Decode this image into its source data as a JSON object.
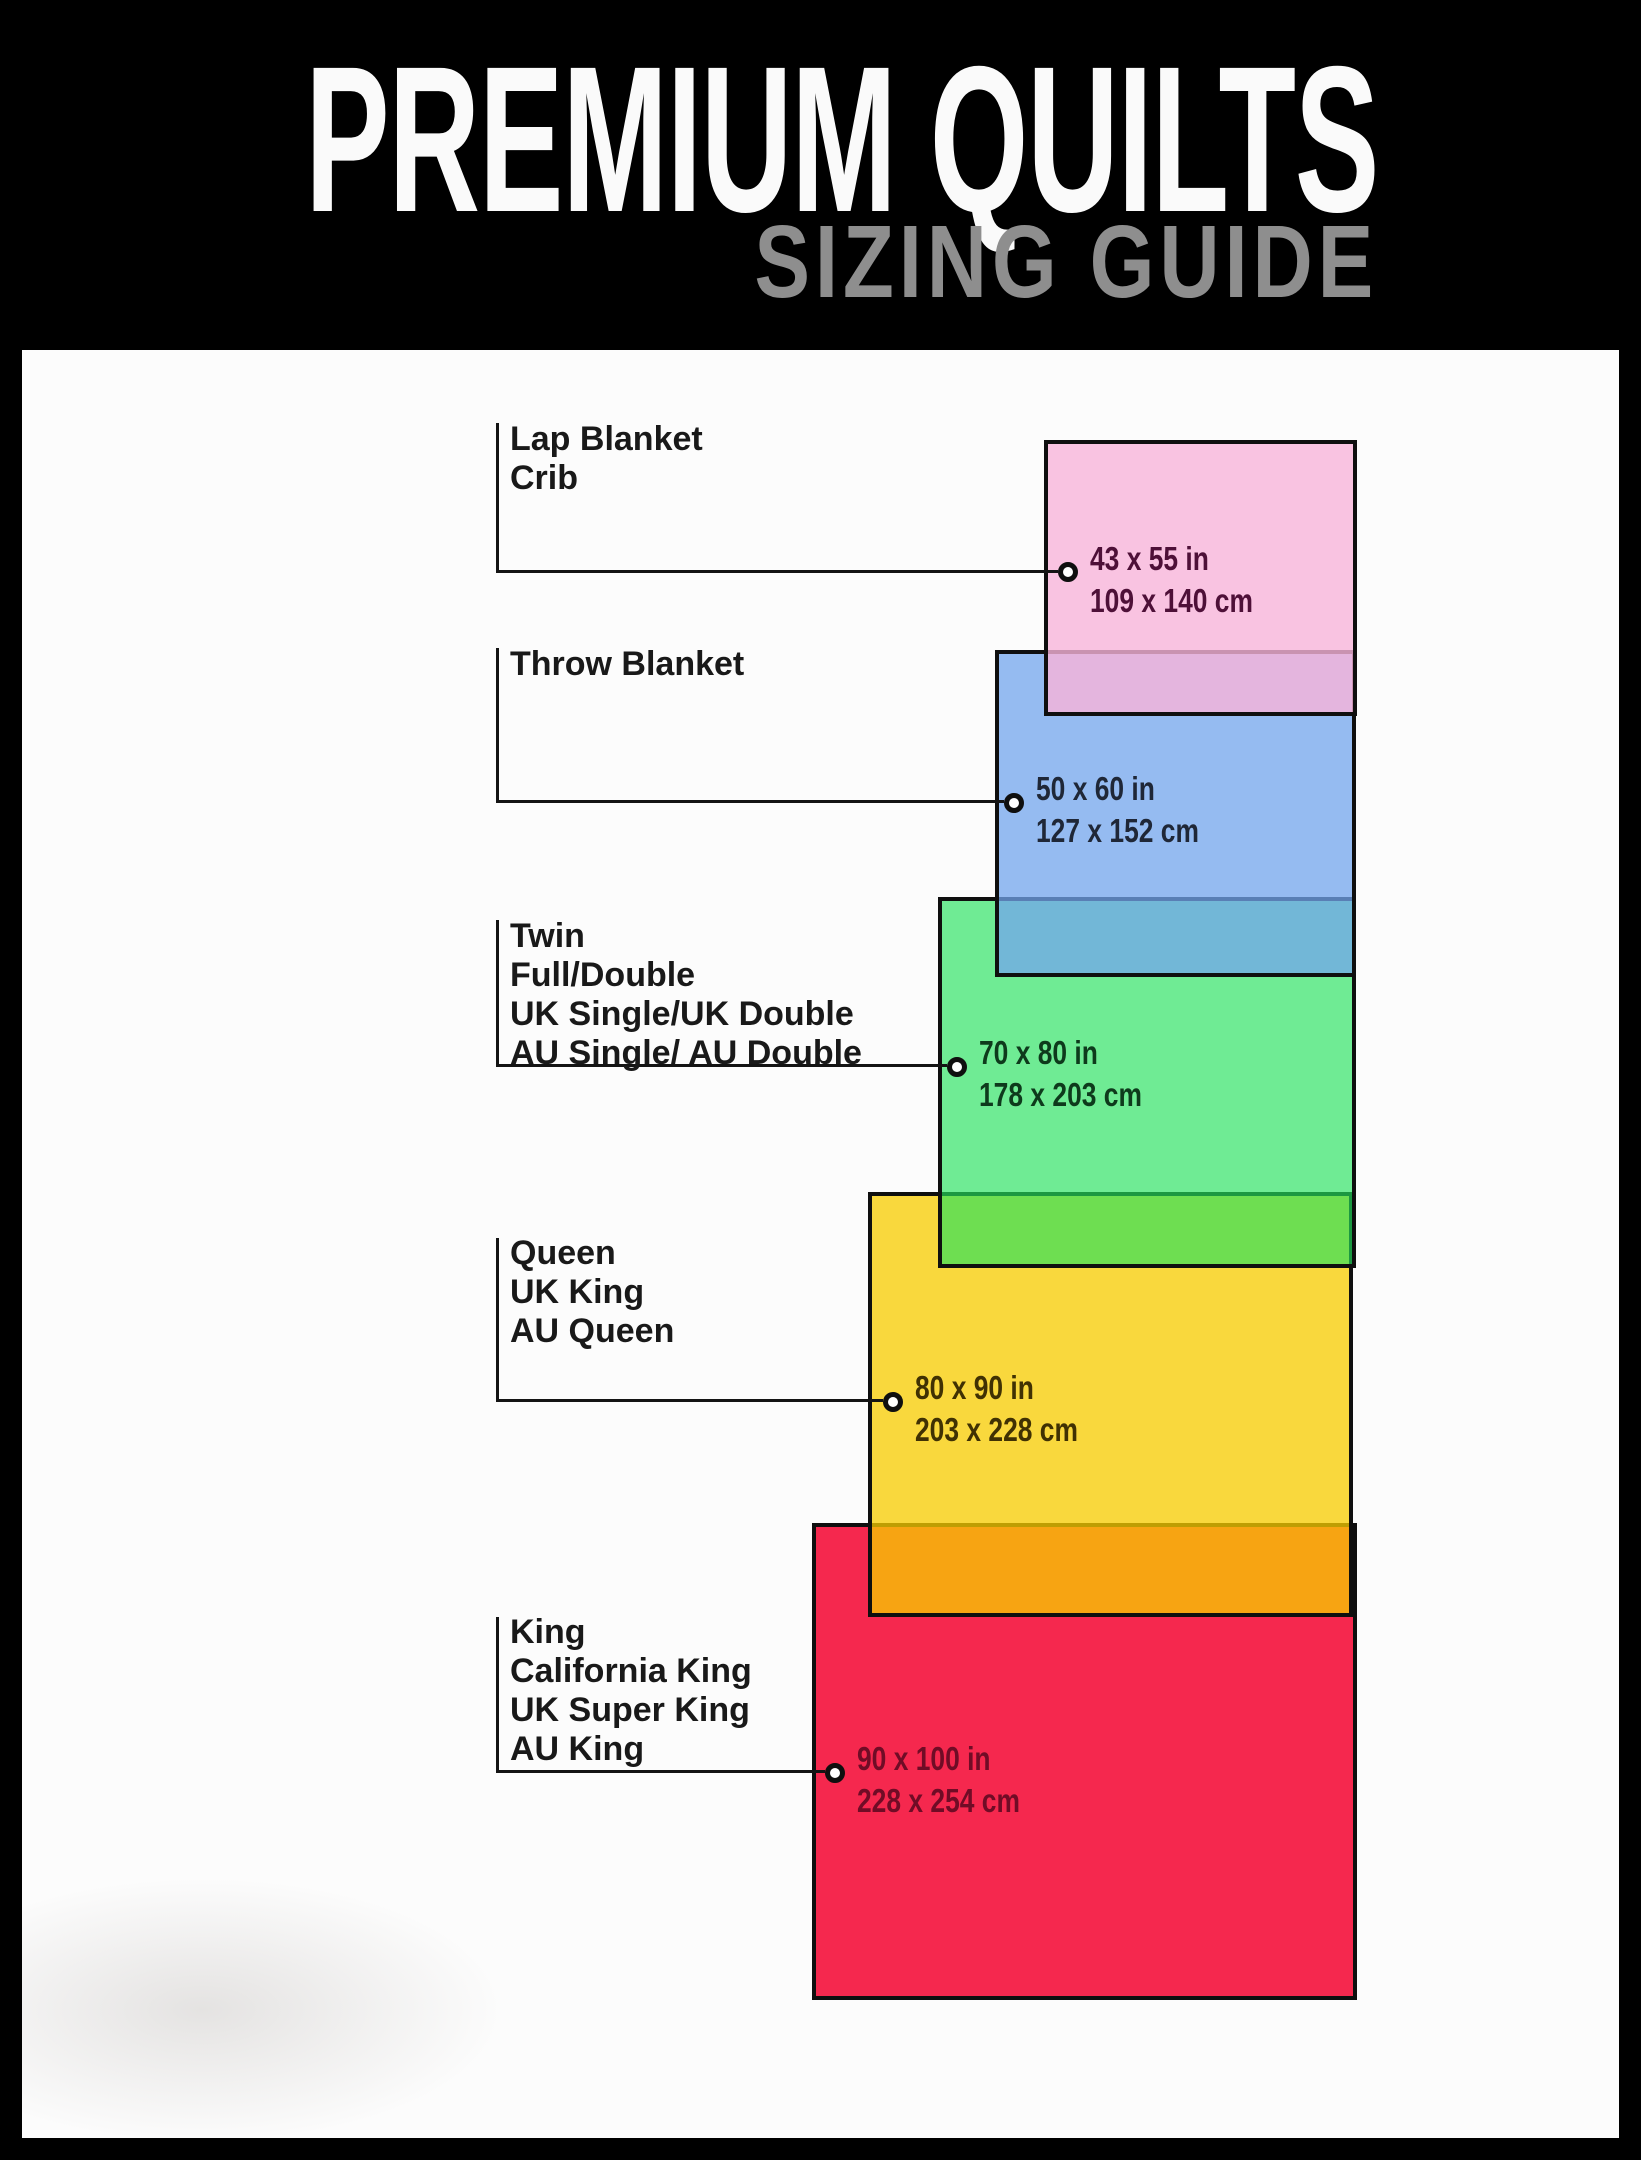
{
  "header": {
    "title": "PREMIUM QUILTS",
    "subtitle": "SIZING GUIDE",
    "title_color": "#fafafa",
    "subtitle_color": "#8e8e8e",
    "background_color": "#000000"
  },
  "panel_background": "#fcfcfc",
  "label_text_color": "#191919",
  "line_color": "#141414",
  "sizes": [
    {
      "label": "Lap Blanket\nCrib",
      "inches": "43 x 55 in",
      "cm": "109 x 140 cm",
      "fill": "rgba(248,180,218,0.8)",
      "dim_text_color": "#4e1038"
    },
    {
      "label": "Throw Blanket",
      "inches": "50 x 60 in",
      "cm": "127 x 152 cm",
      "fill": "rgba(115,165,237,0.75)",
      "dim_text_color": "#1f2737"
    },
    {
      "label": "Twin\nFull/Double\nUK Single/UK Double\nAU Single/ AU Double",
      "inches": "70 x 80 in",
      "cm": "178 x 203 cm",
      "fill": "rgba(35,226,92,0.65)",
      "dim_text_color": "#0e3a1c"
    },
    {
      "label": "Queen\nUK King\nAU Queen",
      "inches": "80 x 90 in",
      "cm": "203 x 228 cm",
      "fill": "rgba(247,204,0,0.76)",
      "dim_text_color": "#403103"
    },
    {
      "label": "King\nCalifornia King\nUK Super King\nAU King",
      "inches": "90 x 100 in",
      "cm": "228 x 254 cm",
      "fill": "#f5284e",
      "dim_text_color": "#700c26"
    }
  ]
}
